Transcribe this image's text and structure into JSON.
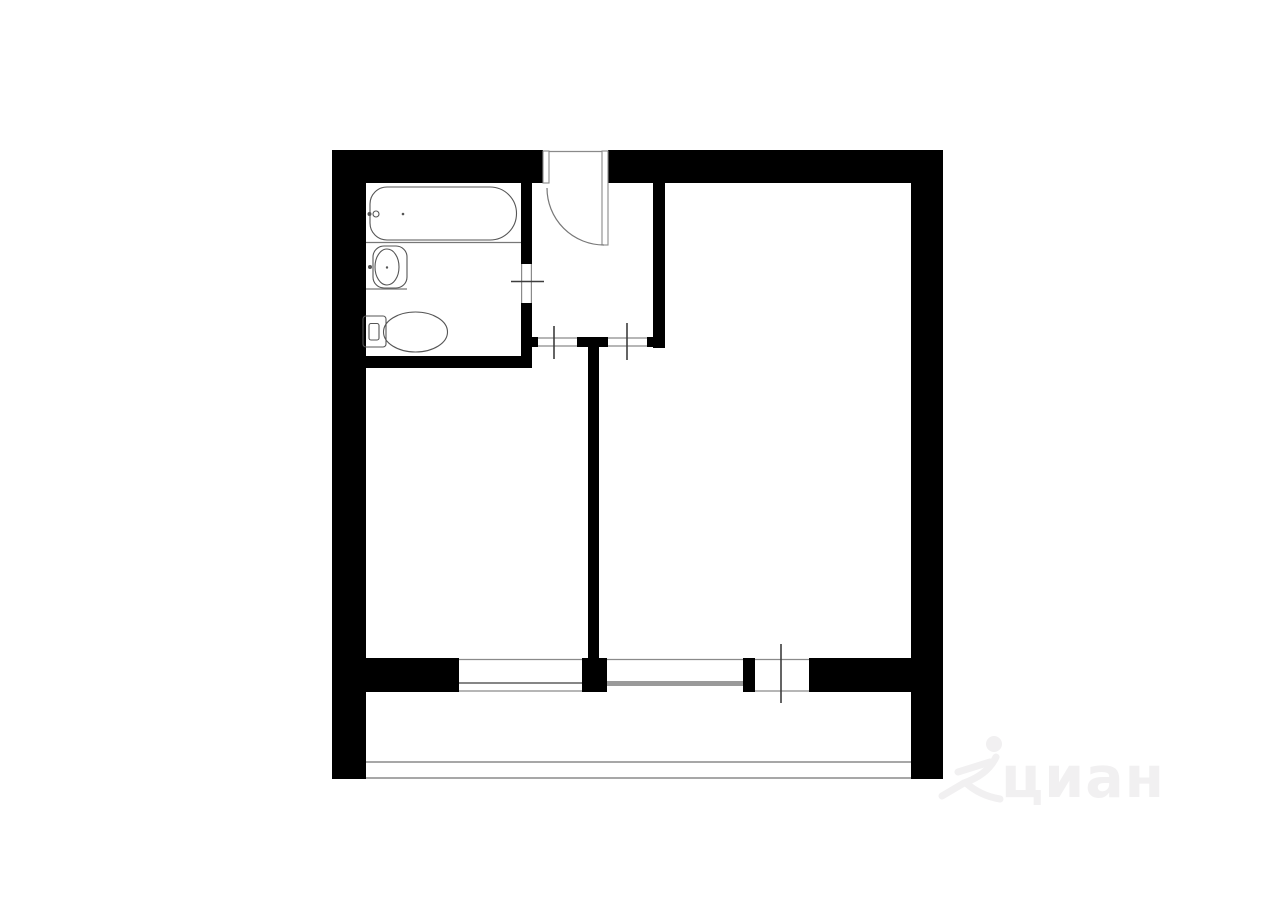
{
  "colors": {
    "wall": "#000000",
    "line": "#8a8a8a",
    "line-dark": "#3d3d3d",
    "band": "#9a9a9a",
    "fixture": "#555555",
    "arc": "#777777",
    "watermark": "#f1f0f1",
    "bg": "#ffffff"
  },
  "floor_plan": {
    "kind": "apartment-floor-plan-drawing",
    "depicted_fixtures": [
      "bathtub",
      "washbasin",
      "toilet"
    ],
    "depicted_features": [
      "entrance-door-with-swing-arc",
      "bathroom-door-opening",
      "room-door-openings",
      "window-openings",
      "balcony-outline"
    ]
  },
  "watermark": {
    "text": "циан",
    "logo": "cian-person-logo"
  }
}
